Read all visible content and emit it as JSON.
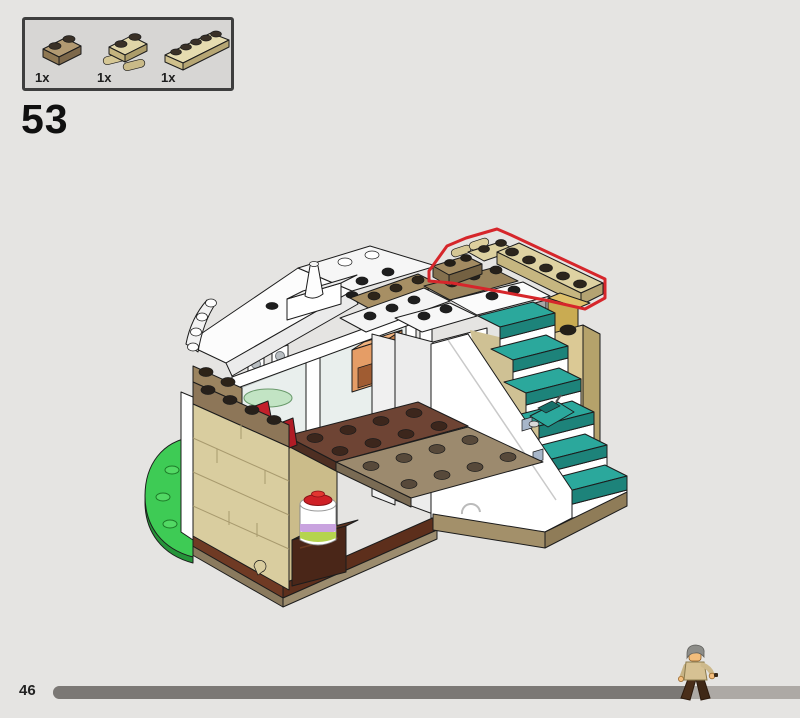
{
  "page": {
    "number": "46",
    "background_color": "#e5e4e2"
  },
  "step": {
    "number": "53"
  },
  "parts_callout": {
    "parts": [
      {
        "name": "plate-1x2-dark-tan",
        "label": "1x",
        "color": "#a8906a"
      },
      {
        "name": "plate-1x2-with-bar-tan",
        "label": "1x",
        "color": "#ddd1a0"
      },
      {
        "name": "plate-1x5-tan",
        "label": "1x",
        "color": "#e3d8ad"
      }
    ]
  },
  "illustration": {
    "name": "lego-building-step-53",
    "highlight_color": "#d6262b",
    "colors": {
      "tan": "#d9cd9f",
      "dark_tan": "#9c8a6e",
      "reddish_brown": "#6f3a24",
      "teal_steps": "#2ba89c",
      "green_baseplate": "#3ecb55",
      "white": "#ffffff",
      "gold_plaque": "#ad8b2e",
      "cake_red": "#cf2026"
    }
  },
  "progress_bar": {
    "fill_color": "#7b7875",
    "track_color": "#ada9a5",
    "fill_fraction": 0.85
  },
  "minifigure": {
    "name": "walking-minifigure"
  }
}
